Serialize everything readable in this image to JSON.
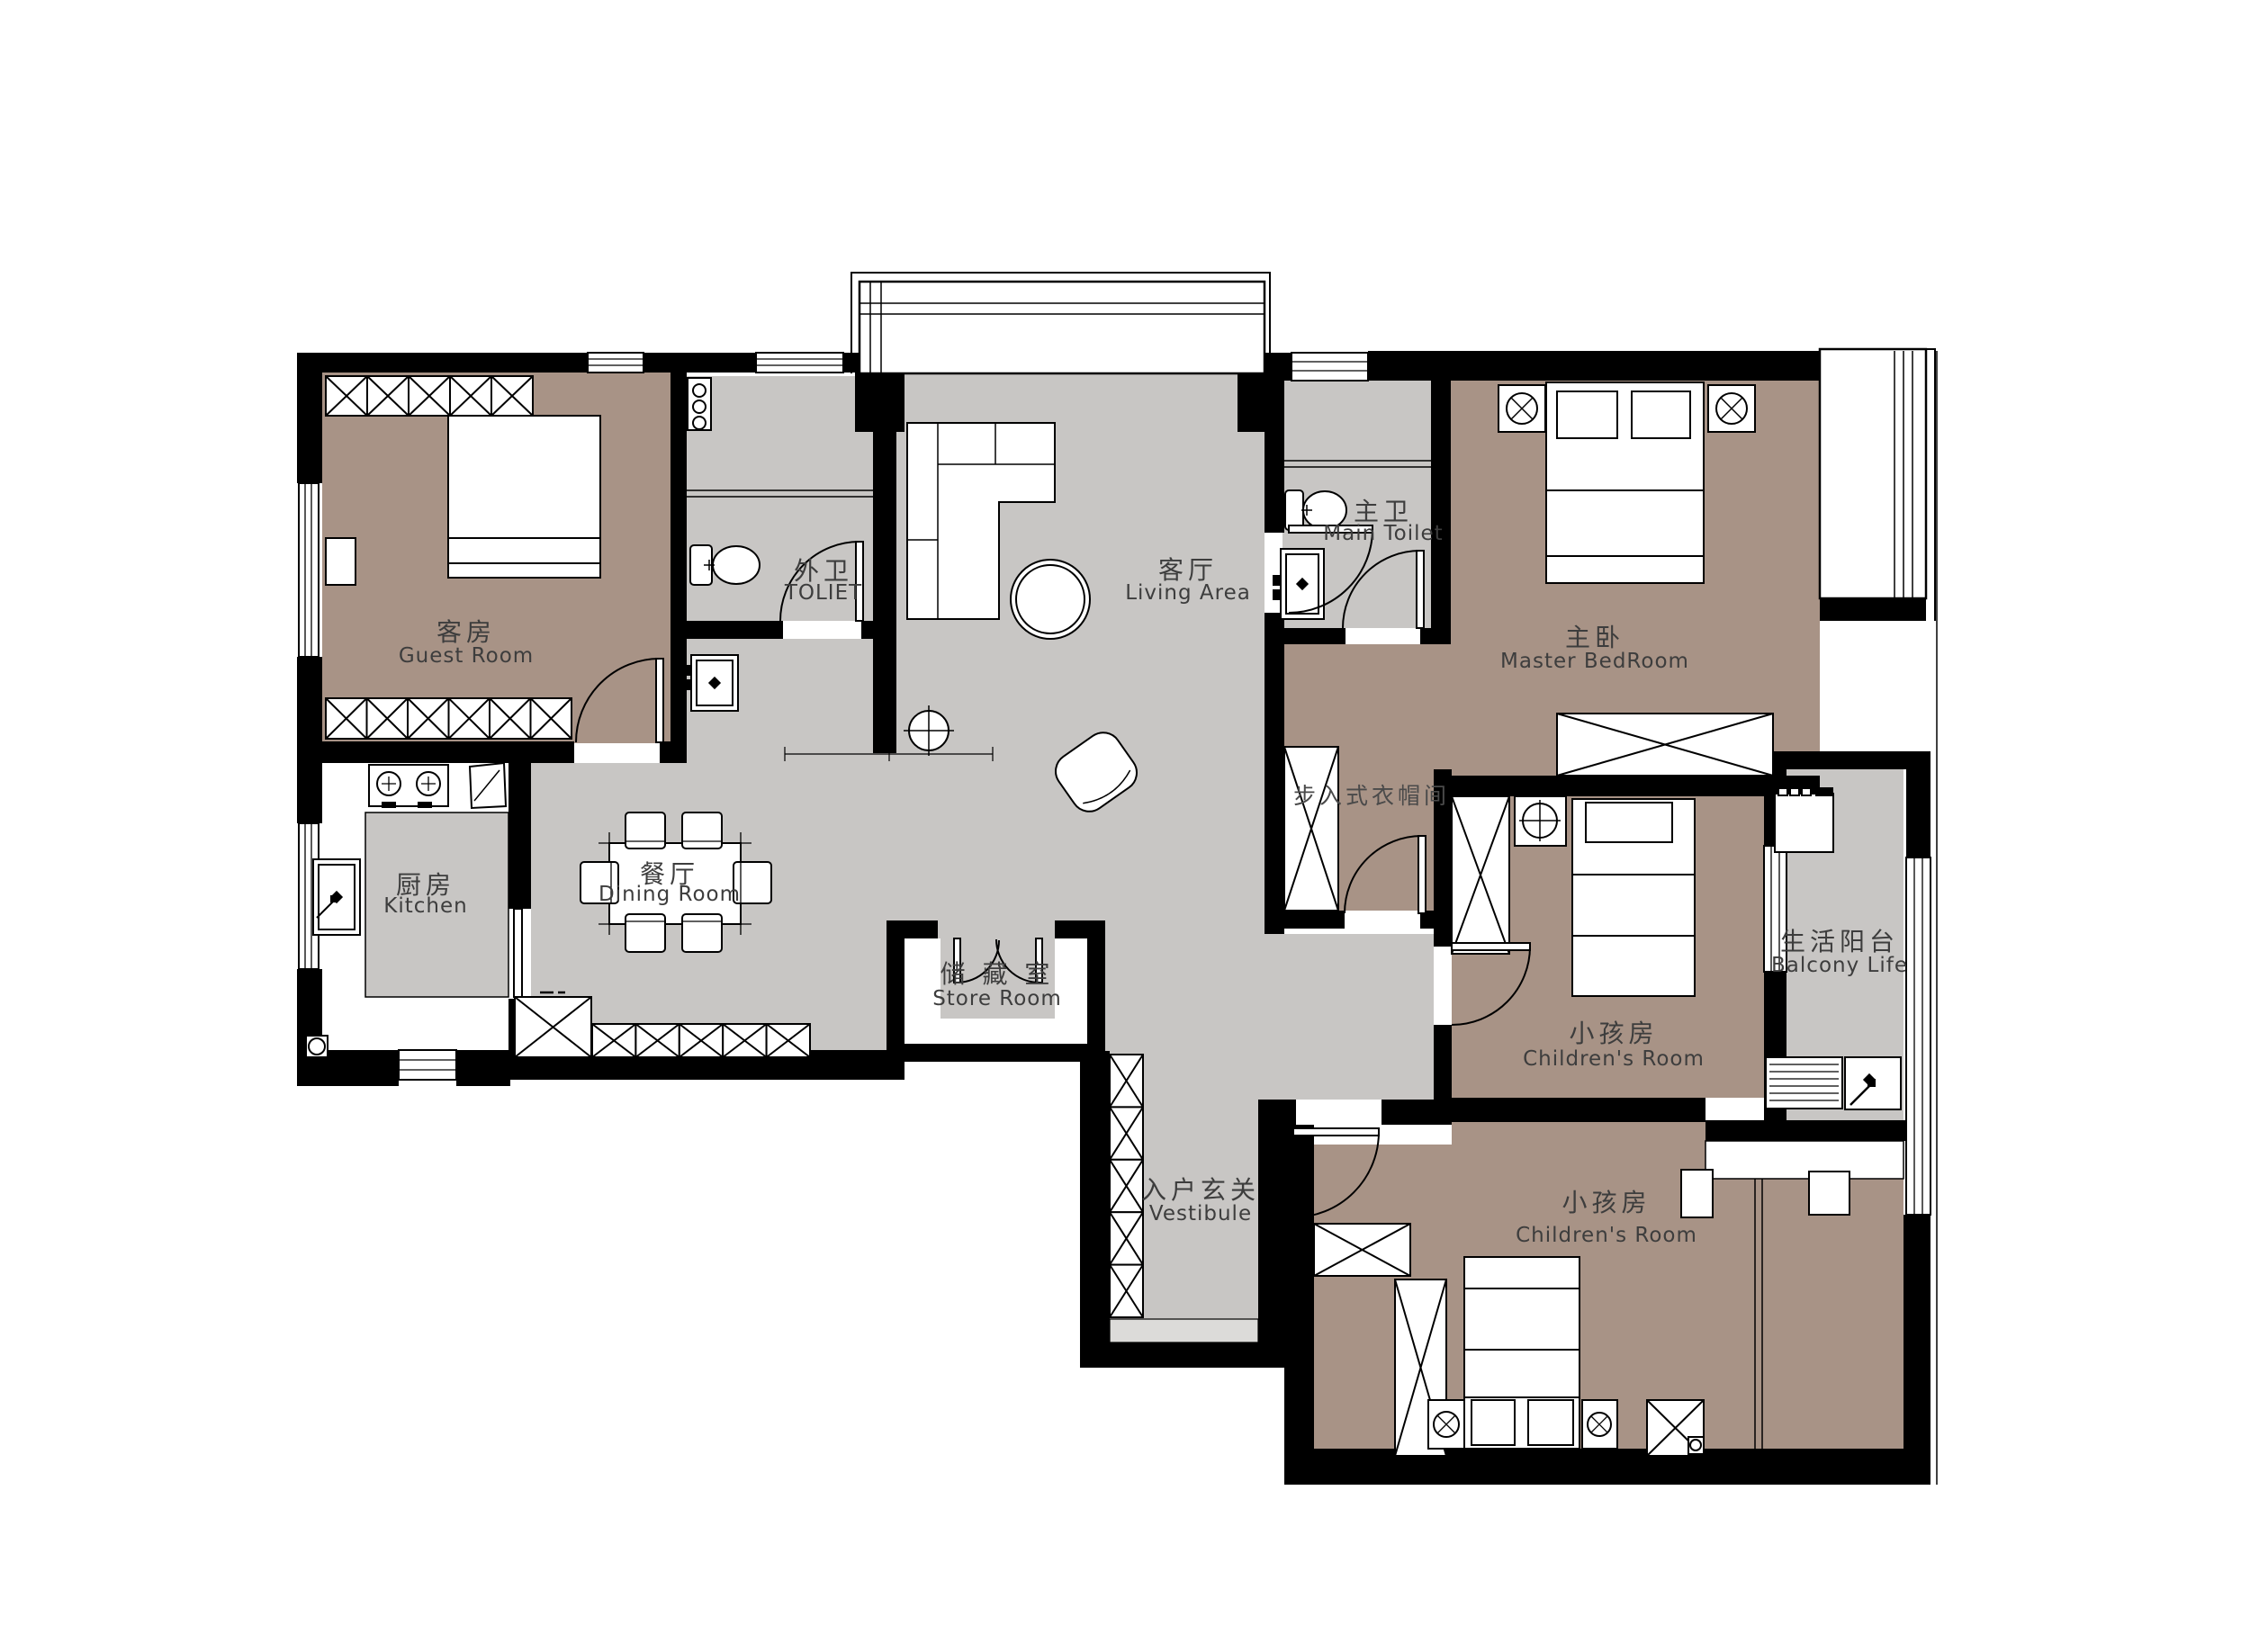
{
  "plan": {
    "type": "apartment-floor-plan",
    "colors": {
      "wall": "#000000",
      "bedroom_floor": "#a89386",
      "common_floor": "#c8c6c4",
      "threshold": "#dcdbd9",
      "background": "#ffffff",
      "label_text": "#3d3d3d"
    }
  },
  "rooms": [
    {
      "id": "guest-room",
      "zh": "客房",
      "en": "Guest Room"
    },
    {
      "id": "toilet-ext",
      "zh": "外卫",
      "en": "TOLIET"
    },
    {
      "id": "living-area",
      "zh": "客厅",
      "en": "Living Area"
    },
    {
      "id": "main-toilet",
      "zh": "主卫",
      "en": "Main Toilet"
    },
    {
      "id": "master-bedroom",
      "zh": "主卧",
      "en": "Master BedRoom"
    },
    {
      "id": "kitchen",
      "zh": "厨房",
      "en": "Kitchen"
    },
    {
      "id": "dining-room",
      "zh": "餐厅",
      "en": "Dining Room"
    },
    {
      "id": "store-room",
      "zh": "储 藏 室",
      "en": "Store Room"
    },
    {
      "id": "walkin-closet",
      "zh": "步入式衣帽间",
      "en": ""
    },
    {
      "id": "children-room-1",
      "zh": "小孩房",
      "en": "Children's Room"
    },
    {
      "id": "children-room-2",
      "zh": "小孩房",
      "en": "Children's Room"
    },
    {
      "id": "balcony",
      "zh": "生活阳台",
      "en": "Balcony Life"
    },
    {
      "id": "vestibule",
      "zh": "入户玄关",
      "en": "Vestibule"
    }
  ]
}
